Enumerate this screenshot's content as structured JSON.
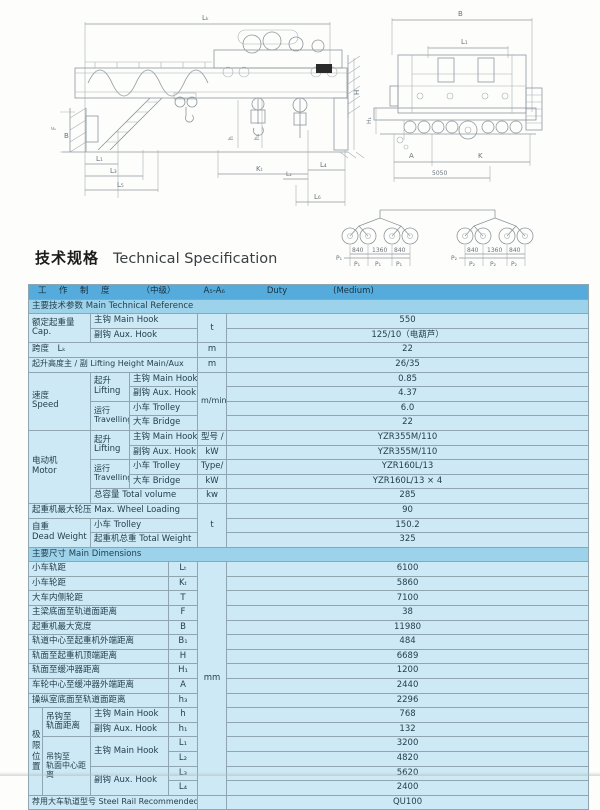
{
  "page": {
    "title_zh": "技术规格",
    "title_en": "Technical Specification"
  },
  "drawing": {
    "labels": {
      "lk": "Lₖ",
      "b_end": "B",
      "l1_end": "L₁",
      "h": "H",
      "h1_end": "H₁",
      "f": "F",
      "b_side": "B",
      "h_hook": "h",
      "h1_hook": "h₁",
      "l1": "L₁",
      "l2": "L₂",
      "l3": "L₃",
      "l4": "L₄",
      "l5": "L₅",
      "l6": "L₆",
      "kt": "Kₜ",
      "a": "A",
      "k": "K",
      "d5050": "5050"
    },
    "wheel": {
      "dims": [
        "840",
        "1360",
        "840"
      ],
      "p1": "P₁",
      "p2": "P₂"
    }
  },
  "table": {
    "rows": [
      {
        "type": "duty",
        "parts": [
          "工　作　制　度",
          "（中级）",
          "A₅-A₆",
          "Duty",
          "(Medium)"
        ]
      },
      {
        "type": "section",
        "cells": [
          {
            "t": "主要技术参数 Main Technical Reference",
            "c": 7
          }
        ]
      },
      {
        "cells": [
          {
            "t": "额定起重量\nCap.",
            "c": 2,
            "r": 2,
            "cls": "ml"
          },
          {
            "t": "主钩 Main Hook",
            "c": 3
          },
          {
            "t": "t",
            "r": 2,
            "al": "c"
          },
          {
            "t": "550",
            "al": "c"
          }
        ]
      },
      {
        "cells": [
          {
            "t": "副钩 Aux. Hook",
            "c": 3
          },
          {
            "t": "125/10（电葫芦）",
            "al": "c"
          }
        ]
      },
      {
        "cells": [
          {
            "t": "跨度　Lₖ",
            "c": 5
          },
          {
            "t": "m",
            "al": "c"
          },
          {
            "t": "22",
            "al": "c"
          }
        ]
      },
      {
        "cells": [
          {
            "t": "起升高度主 / 副 Lifting Height Main/Aux",
            "c": 5,
            "cls": "s8"
          },
          {
            "t": "m",
            "al": "c"
          },
          {
            "t": "26/35",
            "al": "c"
          }
        ]
      },
      {
        "cells": [
          {
            "t": "速度\nSpeed",
            "c": 2,
            "r": 4,
            "cls": "ml"
          },
          {
            "t": "起升\nLifting",
            "r": 2,
            "cls": "ml"
          },
          {
            "t": "主钩 Main Hook",
            "c": 2
          },
          {
            "t": "m/min",
            "r": 4,
            "al": "c",
            "cls": "s8"
          },
          {
            "t": "0.85",
            "al": "c"
          }
        ]
      },
      {
        "cells": [
          {
            "t": "副钩 Aux. Hook",
            "c": 2
          },
          {
            "t": "4.37",
            "al": "c"
          }
        ]
      },
      {
        "cells": [
          {
            "t": "运行\nTravelling",
            "r": 2,
            "cls": "ml s8"
          },
          {
            "t": "小车 Trolley",
            "c": 2
          },
          {
            "t": "6.0",
            "al": "c"
          }
        ]
      },
      {
        "cells": [
          {
            "t": "大车 Bridge",
            "c": 2
          },
          {
            "t": "22",
            "al": "c"
          }
        ]
      },
      {
        "cells": [
          {
            "t": "电动机\nMotor",
            "c": 2,
            "r": 5,
            "cls": "ml"
          },
          {
            "t": "起升\nLifting",
            "r": 2,
            "cls": "ml"
          },
          {
            "t": "主钩 Main Hook",
            "c": 2
          },
          {
            "t": "型号 /",
            "al": "c"
          },
          {
            "t": "YZR355M/110",
            "al": "c"
          }
        ]
      },
      {
        "cells": [
          {
            "t": "副钩 Aux. Hook",
            "c": 2
          },
          {
            "t": "kW",
            "al": "c"
          },
          {
            "t": "YZR355M/110",
            "al": "c"
          }
        ]
      },
      {
        "cells": [
          {
            "t": "运行\nTravelling",
            "r": 2,
            "cls": "ml s8"
          },
          {
            "t": "小车 Trolley",
            "c": 2
          },
          {
            "t": "Type/",
            "al": "c"
          },
          {
            "t": "YZR160L/13",
            "al": "c"
          }
        ]
      },
      {
        "cells": [
          {
            "t": "大车 Bridge",
            "c": 2
          },
          {
            "t": "kW",
            "al": "c"
          },
          {
            "t": "YZR160L/13 × 4",
            "al": "c"
          }
        ]
      },
      {
        "cells": [
          {
            "t": "总容量 Total volume",
            "c": 3
          },
          {
            "t": "kw",
            "al": "c"
          },
          {
            "t": "285",
            "al": "c"
          }
        ]
      },
      {
        "cells": [
          {
            "t": "起重机最大轮压 Max. Wheel Loading",
            "c": 5
          },
          {
            "t": "t",
            "r": 3,
            "al": "c"
          },
          {
            "t": "90",
            "al": "c"
          }
        ]
      },
      {
        "cells": [
          {
            "t": "自重\nDead Weight",
            "c": 2,
            "r": 2,
            "cls": "ml"
          },
          {
            "t": "小车 Trolley",
            "c": 3
          },
          {
            "t": "150.2",
            "al": "c"
          }
        ]
      },
      {
        "cells": [
          {
            "t": "起重机总重 Total Weight",
            "c": 3
          },
          {
            "t": "325",
            "al": "c"
          }
        ]
      },
      {
        "type": "section",
        "cells": [
          {
            "t": "主要尺寸 Main Dimensions",
            "c": 7
          }
        ]
      },
      {
        "cells": [
          {
            "t": "小车轨距",
            "c": 4
          },
          {
            "t": "Lₜ",
            "al": "c"
          },
          {
            "t": "mm",
            "r": 16,
            "al": "c"
          },
          {
            "t": "6100",
            "al": "c"
          }
        ]
      },
      {
        "cells": [
          {
            "t": "小车轮距",
            "c": 4
          },
          {
            "t": "Kₜ",
            "al": "c"
          },
          {
            "t": "5860",
            "al": "c"
          }
        ]
      },
      {
        "cells": [
          {
            "t": "大车内侧轮距",
            "c": 4
          },
          {
            "t": "T",
            "al": "c"
          },
          {
            "t": "7100",
            "al": "c"
          }
        ]
      },
      {
        "cells": [
          {
            "t": "主梁底面至轨道面距离",
            "c": 4
          },
          {
            "t": "F",
            "al": "c"
          },
          {
            "t": "38",
            "al": "c"
          }
        ]
      },
      {
        "cells": [
          {
            "t": "起重机最大宽度",
            "c": 4
          },
          {
            "t": "B",
            "al": "c"
          },
          {
            "t": "11980",
            "al": "c"
          }
        ]
      },
      {
        "cells": [
          {
            "t": "轨道中心至起重机外端距离",
            "c": 4
          },
          {
            "t": "B₁",
            "al": "c"
          },
          {
            "t": "484",
            "al": "c"
          }
        ]
      },
      {
        "cells": [
          {
            "t": "轨面至起重机顶端距离",
            "c": 4
          },
          {
            "t": "H",
            "al": "c"
          },
          {
            "t": "6689",
            "al": "c"
          }
        ]
      },
      {
        "cells": [
          {
            "t": "轨面至缓冲器距离",
            "c": 4
          },
          {
            "t": "H₁",
            "al": "c"
          },
          {
            "t": "1200",
            "al": "c"
          }
        ]
      },
      {
        "cells": [
          {
            "t": "车轮中心至缓冲器外端距离",
            "c": 4
          },
          {
            "t": "A",
            "al": "c"
          },
          {
            "t": "2440",
            "al": "c"
          }
        ]
      },
      {
        "cells": [
          {
            "t": "操纵室底面至轨道面距离",
            "c": 4
          },
          {
            "t": "h₃",
            "al": "c"
          },
          {
            "t": "2296",
            "al": "c"
          }
        ]
      },
      {
        "cells": [
          {
            "t": "极\n限\n位\n置",
            "r": 6,
            "al": "c",
            "cls": "vert"
          },
          {
            "t": "吊钩至\n轨面距离",
            "r": 2,
            "cls": "ml"
          },
          {
            "t": "主钩 Main Hook",
            "c": 2
          },
          {
            "t": "h",
            "al": "c"
          },
          {
            "t": "768",
            "al": "c"
          }
        ]
      },
      {
        "cells": [
          {
            "t": "副钩 Aux. Hook",
            "c": 2
          },
          {
            "t": "h₁",
            "al": "c"
          },
          {
            "t": "132",
            "al": "c"
          }
        ]
      },
      {
        "cells": [
          {
            "t": "吊钩至\n轨面中心距离",
            "r": 4,
            "cls": "ml s8"
          },
          {
            "t": "主钩 Main Hook",
            "c": 2,
            "r": 2
          },
          {
            "t": "L₁",
            "al": "c"
          },
          {
            "t": "3200",
            "al": "c"
          }
        ]
      },
      {
        "cells": [
          {
            "t": "L₂",
            "al": "c"
          },
          {
            "t": "4820",
            "al": "c"
          }
        ]
      },
      {
        "cells": [
          {
            "t": "副钩 Aux. Hook",
            "c": 2,
            "r": 2
          },
          {
            "t": "L₃",
            "al": "c"
          },
          {
            "t": "5620",
            "al": "c"
          }
        ]
      },
      {
        "cells": [
          {
            "t": "L₄",
            "al": "c"
          },
          {
            "t": "2400",
            "al": "c"
          }
        ]
      },
      {
        "cells": [
          {
            "t": "荐用大车轨道型号 Steel Rail Recommended",
            "c": 5,
            "cls": "s8"
          },
          {
            "t": "",
            "al": "c"
          },
          {
            "t": "QU100",
            "al": "c"
          }
        ]
      }
    ]
  }
}
